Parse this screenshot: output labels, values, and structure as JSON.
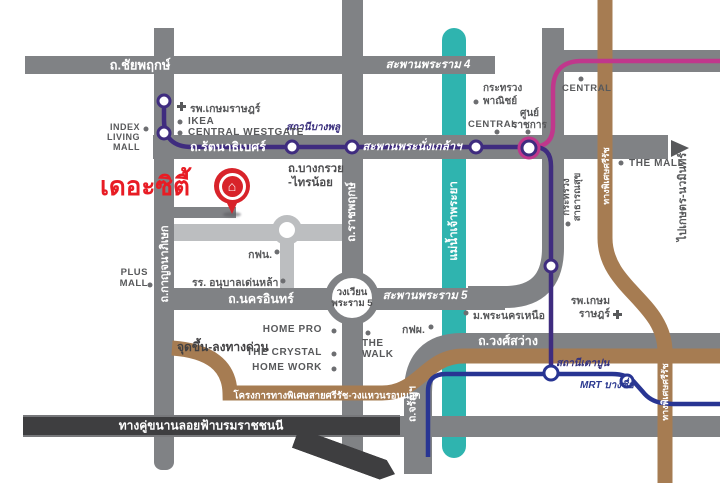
{
  "brand": {
    "name": "เดอะซิตี้",
    "color": "#e81c24"
  },
  "colors": {
    "road_gray": "#808285",
    "road_light": "#bcbec0",
    "road_dark": "#3e3e40",
    "river_teal": "#2fb4af",
    "mrt_purple_line": "#3f2c7f",
    "mrt_pink_line": "#c0378c",
    "mrt_blue_line": "#283593",
    "expressway_brown": "#a67c52",
    "text_gray": "#58595b"
  },
  "roads": {
    "chaiyaphruek": "ถ.ชัยพฤกษ์",
    "rama4_bridge": "สะพานพระราม 4",
    "rattanathibet": "ถ.รัตนาธิเบศร์",
    "phra_nangklao_bridge": "สะพานพระนั่งเกล้าฯ",
    "kanchanaphisek": "ถ.กาญจนาภิเษก",
    "ratchaphruek": "ถ.ราชพฤกษ์",
    "tiwanon": "ถ.ติวานนท์",
    "bang_kruai_line1": "ถ.บางกรวย",
    "bang_kruai_line2": "-ไทรน้อย",
    "nakhon_in": "ถ.นครอินทร์",
    "roundabout_line1": "วงเวียน",
    "roundabout_line2": "พระราม 5",
    "rama5_bridge": "สะพานพระราม 5",
    "wong_sawang": "ถ.วงศ์สว่าง",
    "charan": "ถ.จรัญฯ",
    "borom_parallel": "ทางคู่ขนานลอยฟ้าบรมราชชนนี",
    "si_rat_outer_ring": "โครงการทางพิเศษสายศรีรัช-วงแหวนรอบนอก",
    "si_rat_north": "ทางพิเศษศรีรัช",
    "si_rat_south": "ทางพิเศษศรีรัช",
    "to_kaset_nawamin": "ไปเกษตร-นวมินทร์",
    "ramp_note": "จุดขึ้น-ลงทางด่วน"
  },
  "river": {
    "name": "แม่น้ำเจ้าพระยา"
  },
  "transit": {
    "bang_phlu": "สถานีบางพลู",
    "tao_poon": "สถานีเตาปูน",
    "bang_sue": "MRT บางซื่อ"
  },
  "pois": {
    "kasemrad_nw": "รพ.เกษมราษฎร์",
    "ikea": "IKEA",
    "central_westgate": "CENTRAL WESTGATE",
    "index_l1": "INDEX",
    "index_l2": "LIVING",
    "index_l3": "MALL",
    "commerce_l1": "กระทรวง",
    "commerce_l2": "พาณิชย์",
    "central_rattanathibet": "CENTRAL",
    "gov_l1": "ศูนย์",
    "gov_l2": "ราชการ",
    "central_ne": "CENTRAL",
    "the_mall": "THE MALL",
    "health_l1": "กระทรวง",
    "health_l2": "สาธารณสุข",
    "plus_l1": "PLUS",
    "plus_l2": "MALL",
    "mea": "กฟน.",
    "denla_school": "รร. อนุบาลเด่นหล้า",
    "home_pro": "HOME PRO",
    "the_crystal": "THE CRYSTAL",
    "home_work": "HOME WORK",
    "walk_l1": "THE",
    "walk_l2": "WALK",
    "egat": "กฟผ.",
    "kmutnb": "ม.พระนครเหนือ",
    "kasemrad_se_l1": "รพ.เกษม",
    "kasemrad_se_l2": "ราษฎร์"
  }
}
